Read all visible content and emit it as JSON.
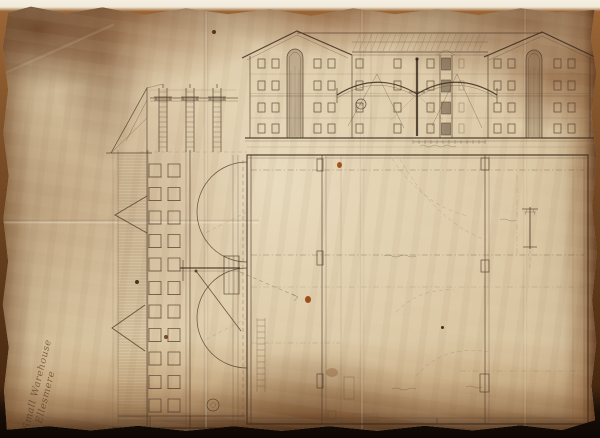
{
  "artifact": {
    "description": "Hand-drawn architectural plan of a warehouse (elevation, side section and floor plan) in ink on aged, water-stained paper",
    "inscription": {
      "line1": "Small Warehouse",
      "line2": "Ellesmere"
    }
  },
  "palette": {
    "paper": "#d9c5a1",
    "paper_highlight": "#e9dcbd",
    "ink": "#4b3827",
    "ink_dark": "#3c2c1d",
    "stain_dark": "#5e3418",
    "stain_mid": "#8a5a2e",
    "backdrop_top": "#f4eee2",
    "backdrop_bottom": "#0d0704"
  }
}
